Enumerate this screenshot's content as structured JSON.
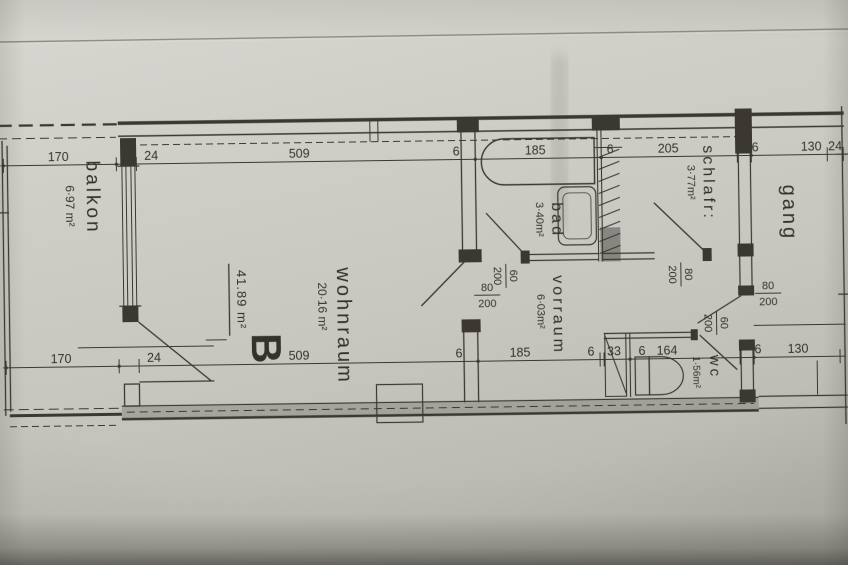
{
  "plan": {
    "type_label": "B",
    "total_area": "41.89 m²"
  },
  "rooms": {
    "balkon": {
      "name": "balkon",
      "area": "6·97 m²"
    },
    "wohnraum": {
      "name": "wohnraum",
      "area": "20·16 m²"
    },
    "bad": {
      "name": "bad",
      "area": "3·40m²"
    },
    "vorraum": {
      "name": "vorraum",
      "area": "6·03m²"
    },
    "schlafr": {
      "name": "schlafr:",
      "area": "3·77m²"
    },
    "gang": {
      "name": "gang",
      "area": ""
    },
    "wc": {
      "name": "wc",
      "area": "1·56m²"
    }
  },
  "dims": {
    "top": [
      "170",
      "24",
      "509",
      "6",
      "185",
      "6",
      "205",
      "6",
      "130",
      "24"
    ],
    "bottom": [
      "170",
      "24",
      "509",
      "6",
      "185",
      "6",
      "33",
      "6",
      "164",
      "6",
      "130"
    ]
  },
  "doors": {
    "bad": {
      "width": "60",
      "height": "200"
    },
    "living": {
      "width": "80",
      "height": "200"
    },
    "bedroom": {
      "width": "80",
      "height": "200"
    },
    "entrance": {
      "width": "80",
      "height": "200"
    },
    "wc": {
      "width": "60",
      "height": "200"
    }
  }
}
